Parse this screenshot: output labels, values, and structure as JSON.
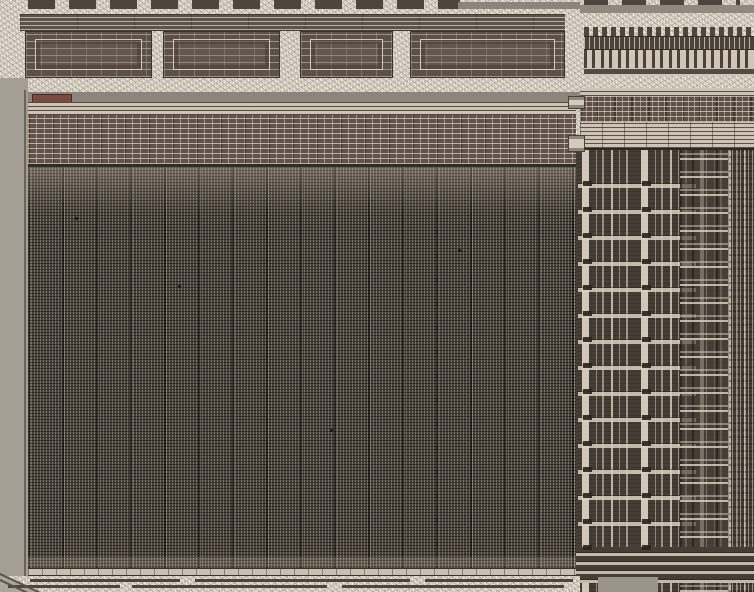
{
  "meta": {
    "subject": "integrated-circuit-die-micrograph",
    "description": "Microscope photograph of a silicon die: large memory cell array with row of drivers above, peripheral logic band on top, column decoder and vertical bus wiring strip on the right, plain die-edge seal on the left and bottom",
    "width_px": 754,
    "height_px": 592
  },
  "palette": {
    "speckleBase": "#d8d0c2",
    "grayBand": "#8b857d",
    "grayStrip": "#a49e94",
    "darkBlock": "#4e453d",
    "arrayBase": "#474039",
    "stripBase": "#453e37",
    "redBlock": "#7b4a3e",
    "lightMetal": "#cdc4b5"
  },
  "regions": {
    "top_logic_band": "peripheral logic and metal routing band",
    "row_driver_band": "row of repeated driver cells",
    "memory_array": "dense memory cell array",
    "column_mux_strip": "column decoder / vertical bus strip",
    "sense_cell_column": "repeated sense cells column",
    "die_edge_left": "plain passivated die edge",
    "die_edge_bottom": "bottom die edge with guard traces",
    "red_test_block": "dark red test structure"
  },
  "generated": {
    "blocks_c": [
      {
        "x": 25,
        "w": 127
      },
      {
        "x": 163,
        "w": 117
      },
      {
        "x": 300,
        "w": 93
      },
      {
        "x": 410,
        "w": 155
      }
    ],
    "i_beams": [
      {
        "x": 568,
        "y": 96,
        "w": 17,
        "h": 13
      },
      {
        "x": 568,
        "y": 135,
        "w": 17,
        "h": 17
      }
    ],
    "via_columns": [
      {
        "left": 7
      },
      {
        "left": 66
      }
    ],
    "trace_rows": [
      {
        "y": 579,
        "segments": [
          {
            "x": 30,
            "w": 150
          },
          {
            "x": 195,
            "w": 215
          },
          {
            "x": 425,
            "w": 148
          }
        ]
      },
      {
        "y": 585,
        "segments": [
          {
            "x": 8,
            "w": 112
          },
          {
            "x": 132,
            "w": 195
          },
          {
            "x": 342,
            "w": 222
          }
        ]
      }
    ],
    "diag_lines": [
      {
        "top": 572
      },
      {
        "top": 578
      }
    ],
    "defects": [
      {
        "x": 47,
        "y": 50
      },
      {
        "x": 150,
        "y": 118
      },
      {
        "x": 302,
        "y": 262
      },
      {
        "x": 430,
        "y": 82
      }
    ]
  }
}
